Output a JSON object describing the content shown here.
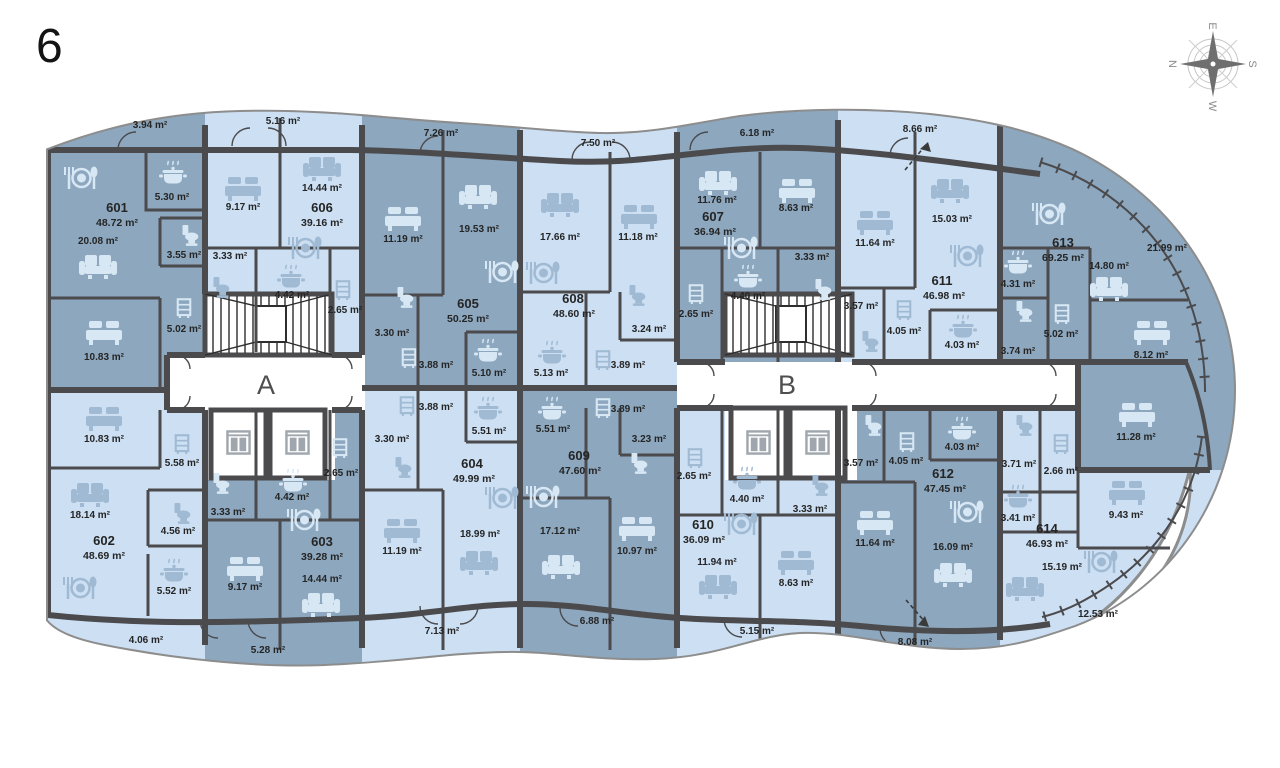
{
  "floor_number": "6",
  "compass": {
    "top": "E",
    "right": "S",
    "bottom": "W",
    "left": "N"
  },
  "cores": {
    "a": "A",
    "b": "B"
  },
  "colors": {
    "unit_dark": "#8CA7BE",
    "unit_light": "#CCDFF3",
    "wall": "#4B4A4D",
    "outline": "#8D8D8D",
    "icon_on_dark": "#D8E7F4",
    "icon_on_light": "#9FBAD2",
    "label_text": "#252525"
  },
  "apartments": {
    "a601": {
      "number": "601",
      "area": "48.72 m²",
      "rooms": {
        "living": "20.08 m²",
        "bedroom": "10.83 m²",
        "kitchen": "5.30 m²",
        "wc": "3.55 m²",
        "hall": "5.02 m²",
        "balcony": "3.94 m²"
      }
    },
    "a602": {
      "number": "602",
      "area": "48.69 m²",
      "rooms": {
        "living": "18.14 m²",
        "bedroom": "10.83 m²",
        "kitchen": "5.52 m²",
        "wc": "4.56 m²",
        "hall": "5.58 m²",
        "balcony": "4.06 m²"
      }
    },
    "a603": {
      "number": "603",
      "area": "39.28 m²",
      "rooms": {
        "living": "14.44 m²",
        "bedroom": "9.17 m²",
        "kitchen": "4.42 m²",
        "hall": "3.33 m²",
        "closet": "2.65 m²",
        "balcony": "5.28 m²"
      }
    },
    "a604": {
      "number": "604",
      "area": "49.99 m²",
      "rooms": {
        "living": "18.99 m²",
        "bedroom": "11.19 m²",
        "kitchen": "5.51 m²",
        "hall": "3.88 m²",
        "wc": "3.30 m²",
        "balcony": "7.13 m²"
      }
    },
    "a605": {
      "number": "605",
      "area": "50.25 m²",
      "rooms": {
        "living": "19.53 m²",
        "bedroom": "11.19 m²",
        "kitchen": "5.10 m²",
        "hall": "3.88 m²",
        "wc": "3.30 m²",
        "balcony": "7.26 m²"
      }
    },
    "a606": {
      "number": "606",
      "area": "39.16 m²",
      "rooms": {
        "living": "14.44 m²",
        "bedroom": "9.17 m²",
        "kitchen": "4.42 m²",
        "hall": "3.33 m²",
        "closet": "2.65 m²",
        "balcony": "5.16 m²"
      }
    },
    "a607": {
      "number": "607",
      "area": "36.94 m²",
      "rooms": {
        "living": "11.76 m²",
        "bedroom": "8.63 m²",
        "kitchen": "4.40 m²",
        "hall": "3.33 m²",
        "closet": "2.65 m²",
        "balcony": "6.18 m²"
      }
    },
    "a608": {
      "number": "608",
      "area": "48.60 m²",
      "rooms": {
        "living": "17.66 m²",
        "bedroom": "11.18 m²",
        "kitchen": "5.13 m²",
        "hall": "3.89 m²",
        "wc": "3.24 m²",
        "balcony": "7.50 m²"
      }
    },
    "a609": {
      "number": "609",
      "area": "47.60 m²",
      "rooms": {
        "living": "17.12 m²",
        "bedroom": "10.97 m²",
        "kitchen": "5.51 m²",
        "hall": "3.89 m²",
        "wc": "3.23 m²",
        "balcony": "6.88 m²"
      }
    },
    "a610": {
      "number": "610",
      "area": "36.09 m²",
      "rooms": {
        "living": "11.94 m²",
        "bedroom": "8.63 m²",
        "kitchen": "4.40 m²",
        "hall": "3.33 m²",
        "closet": "2.65 m²",
        "balcony": "5.15 m²"
      }
    },
    "a611": {
      "number": "611",
      "area": "46.98 m²",
      "rooms": {
        "living": "15.03 m²",
        "bedroom": "11.64 m²",
        "kitchen": "4.03 m²",
        "hall": "4.05 m²",
        "wc": "3.57 m²",
        "balcony": "8.66 m²"
      }
    },
    "a612": {
      "number": "612",
      "area": "47.45 m²",
      "rooms": {
        "living": "16.09 m²",
        "bedroom": "11.64 m²",
        "kitchen": "4.03 m²",
        "hall": "4.05 m²",
        "wc": "3.57 m²",
        "balcony": "8.08 m²"
      }
    },
    "a613": {
      "number": "613",
      "area": "69.25 m²",
      "rooms": {
        "living": "14.80 m²",
        "bedroom1": "11.28 m²",
        "bedroom2": "8.12 m²",
        "kitchen": "4.31 m²",
        "hall": "5.02 m²",
        "wc": "3.74 m²",
        "terrace": "21.99 m²"
      }
    },
    "a614": {
      "number": "614",
      "area": "46.93 m²",
      "rooms": {
        "living": "15.19 m²",
        "bedroom": "9.43 m²",
        "kitchen": "3.41 m²",
        "hall": "2.66 m²",
        "wc": "3.71 m²",
        "terrace": "12.53 m²"
      }
    }
  }
}
